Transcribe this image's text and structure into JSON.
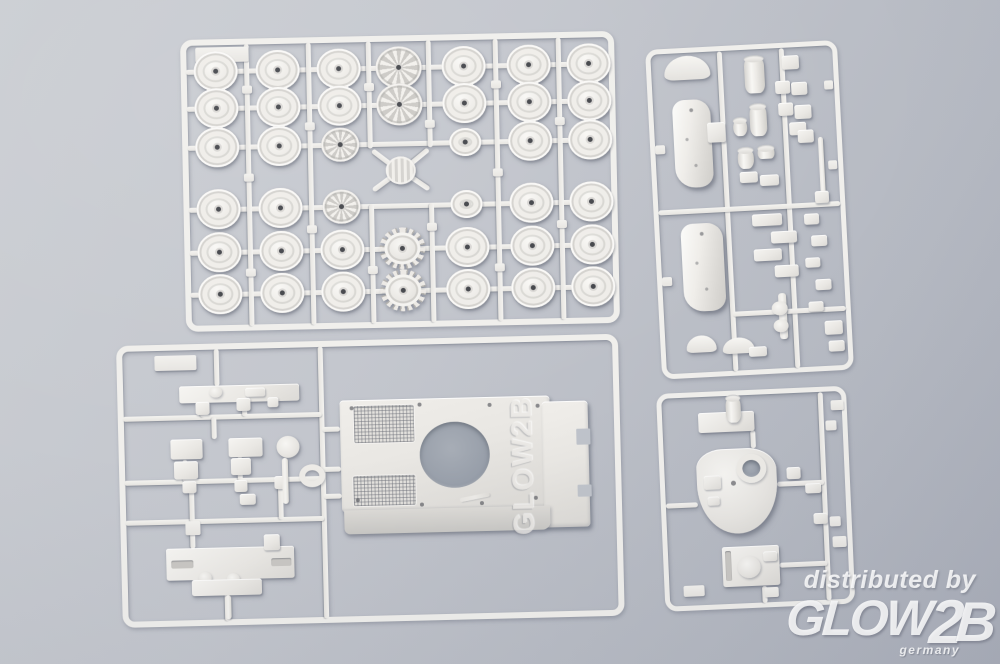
{
  "scene": {
    "type": "product-photo",
    "subject": "white plastic model kit sprues with tank parts on gray surface",
    "background_top_color": "#cbced3",
    "background_bottom_color": "#abafba",
    "plastic_color": "#f0efec"
  },
  "watermark": {
    "line1": "distributed by",
    "logo_main": "GLOW",
    "logo_digit": "2",
    "logo_last": "B",
    "line3": "germany",
    "embossed_logo": "GLOW2B",
    "text_color": "#ffffff"
  },
  "sprues": {
    "wheel_sprue": {
      "x": 180,
      "y": 40,
      "w": 434,
      "h": 292,
      "rot": -1.2,
      "bw": 6,
      "cols": [
        35,
        97,
        158,
        218,
        283,
        348,
        408
      ],
      "rows": [
        32,
        69,
        108,
        170,
        213,
        255
      ],
      "types": [
        [
          "p",
          "p",
          "p",
          "S",
          "p",
          "p",
          "p"
        ],
        [
          "p",
          "p",
          "p",
          "S",
          "p",
          "p",
          "p"
        ],
        [
          "p",
          "p",
          "s",
          "-",
          "m",
          "p",
          "p"
        ],
        [
          "p",
          "p",
          "s",
          "-",
          "m",
          "p",
          "p"
        ],
        [
          "p",
          "p",
          "p",
          "T",
          "p",
          "p",
          "p"
        ],
        [
          "p",
          "p",
          "p",
          "T",
          "p",
          "p",
          "p"
        ]
      ],
      "wheel_sizes": {
        "p": [
          44,
          40
        ],
        "m": [
          32,
          28
        ],
        "s": [
          38,
          34
        ],
        "S": [
          46,
          42
        ],
        "T": [
          46,
          42
        ]
      },
      "wheel_names": {
        "p": "road-wheel",
        "m": "small-road-wheel",
        "s": "spoked-wheel",
        "S": "idler-sprocket-wheel",
        "T": "drive-sprocket"
      },
      "verticals": [
        66,
        128,
        315,
        378
      ],
      "center_verticals": [
        188,
        248
      ],
      "center_gap_rows": [
        112,
        168
      ],
      "diagonals": [
        [
          190,
          114,
          214,
          133
        ],
        [
          246,
          114,
          222,
          133
        ],
        [
          190,
          154,
          214,
          137
        ],
        [
          246,
          154,
          222,
          137
        ]
      ],
      "label_tab": [
        15,
        8,
        53,
        15
      ],
      "center_part": [
        203,
        121,
        30,
        28
      ]
    },
    "detail_sprue": {
      "x": 645,
      "y": 50,
      "w": 192,
      "h": 330,
      "rot": -3,
      "bw": 5,
      "runners": [
        [
          74,
          5,
          74,
          325
        ],
        [
          136,
          5,
          136,
          325
        ],
        [
          5,
          163,
          187,
          163
        ],
        [
          74,
          268,
          187,
          268
        ]
      ],
      "parts": [
        [
          "arc",
          18,
          8,
          46,
          24,
          {
            "nm": "fender-part"
          }
        ],
        [
          "hullside",
          24,
          52,
          38,
          88,
          {
            "nm": "hull-side-panel"
          }
        ],
        [
          "rect",
          58,
          76,
          18,
          20
        ],
        [
          "hullside",
          26,
          176,
          42,
          88,
          {
            "nm": "hull-side-panel"
          }
        ],
        [
          "cyl",
          98,
          13,
          20,
          36,
          {
            "nm": "exhaust-pipe"
          }
        ],
        [
          "cyl",
          101,
          61,
          17,
          31,
          {
            "nm": "exhaust-pipe"
          }
        ],
        [
          "cyl",
          84,
          74,
          14,
          17
        ],
        [
          "cyl",
          87,
          104,
          16,
          20
        ],
        [
          "cyl",
          107,
          103,
          17,
          12
        ],
        [
          "rect",
          88,
          127,
          18,
          11
        ],
        [
          "rect",
          108,
          131,
          19,
          11
        ],
        [
          "rect",
          136,
          13,
          17,
          14
        ],
        [
          "rect",
          128,
          38,
          15,
          13
        ],
        [
          "rect",
          144,
          40,
          16,
          13
        ],
        [
          "rect",
          130,
          60,
          15,
          13
        ],
        [
          "rect",
          146,
          63,
          17,
          14
        ],
        [
          "rect",
          140,
          80,
          17,
          13
        ],
        [
          "rect",
          148,
          88,
          16,
          13
        ],
        [
          "rod",
          168,
          96,
          5,
          60
        ],
        [
          "rect",
          162,
          150,
          14,
          12
        ],
        [
          "rect",
          98,
          170,
          30,
          12
        ],
        [
          "rect",
          116,
          188,
          26,
          12
        ],
        [
          "rect",
          98,
          205,
          28,
          12
        ],
        [
          "rect",
          118,
          222,
          24,
          12
        ],
        [
          "rect",
          150,
          172,
          15,
          11
        ],
        [
          "rect",
          156,
          194,
          16,
          11
        ],
        [
          "rect",
          149,
          216,
          15,
          10
        ],
        [
          "rect",
          158,
          238,
          16,
          11
        ],
        [
          "rect",
          150,
          260,
          15,
          10
        ],
        [
          "rod",
          120,
          250,
          8,
          46,
          {
            "nm": "barrel-part"
          }
        ],
        [
          "circle",
          113,
          258,
          16,
          14
        ],
        [
          "circle",
          114,
          276,
          15,
          13
        ],
        [
          "arc",
          26,
          288,
          30,
          17
        ],
        [
          "arc",
          62,
          292,
          32,
          16
        ],
        [
          "rect",
          88,
          302,
          18,
          10
        ],
        [
          "rect",
          165,
          280,
          18,
          14
        ],
        [
          "rect",
          168,
          300,
          16,
          11
        ],
        [
          "tab",
          5,
          96,
          10,
          9
        ],
        [
          "tab",
          5,
          228,
          10,
          9
        ],
        [
          "tab",
          177,
          40,
          9,
          9
        ],
        [
          "tab",
          177,
          120,
          9,
          9
        ]
      ]
    },
    "hull_sprue": {
      "x": 116,
      "y": 346,
      "w": 502,
      "h": 282,
      "rot": -1.4,
      "bw": 6,
      "runners": [
        [
          204,
          5,
          204,
          277
        ],
        [
          5,
          73,
          204,
          73
        ],
        [
          5,
          137,
          204,
          137
        ],
        [
          5,
          177,
          204,
          177
        ],
        [
          100,
          5,
          100,
          42
        ],
        [
          85,
          58,
          85,
          73
        ],
        [
          127,
          55,
          127,
          73
        ],
        [
          96,
          73,
          96,
          95
        ],
        [
          66,
          115,
          66,
          137
        ],
        [
          121,
          113,
          121,
          137
        ],
        [
          72,
          137,
          72,
          177
        ],
        [
          161,
          137,
          161,
          177
        ],
        [
          72,
          177,
          72,
          204
        ],
        [
          105,
          250,
          105,
          277
        ],
        [
          204,
          88,
          222,
          88
        ],
        [
          204,
          128,
          222,
          128
        ],
        [
          204,
          155,
          222,
          155
        ]
      ],
      "parts": [
        [
          "tab",
          38,
          11,
          42,
          15,
          {
            "nm": "sprue-label-tab"
          }
        ],
        [
          "rect",
          62,
          42,
          120,
          17,
          {
            "nm": "long-detail-part"
          }
        ],
        [
          "circle",
          92,
          43,
          13,
          11
        ],
        [
          "rect",
          128,
          45,
          20,
          9
        ],
        [
          "rect",
          78,
          58,
          14,
          13
        ],
        [
          "rect",
          119,
          55,
          14,
          13
        ],
        [
          "rect",
          150,
          55,
          11,
          10
        ],
        [
          "rect",
          52,
          95,
          32,
          20,
          {
            "nm": "bracket-part"
          }
        ],
        [
          "rect",
          110,
          95,
          34,
          19,
          {
            "nm": "bracket-part"
          }
        ],
        [
          "rect",
          55,
          117,
          24,
          18
        ],
        [
          "rect",
          112,
          115,
          20,
          17
        ],
        [
          "rect",
          63,
          137,
          14,
          12
        ],
        [
          "rect",
          115,
          137,
          13,
          12
        ],
        [
          "rect",
          155,
          134,
          13,
          13
        ],
        [
          "circle",
          158,
          94,
          23,
          22,
          {
            "nm": "pulley-part"
          }
        ],
        [
          "rod",
          163,
          116,
          6,
          46
        ],
        [
          "ring",
          180,
          123,
          26,
          23,
          {
            "nm": "ring-part"
          }
        ],
        [
          "rect",
          120,
          151,
          16,
          11
        ],
        [
          "tab",
          65,
          177,
          15,
          14
        ],
        [
          "rect",
          45,
          204,
          128,
          32,
          {
            "nm": "hull-lower-part"
          }
        ],
        [
          "slot",
          50,
          216,
          22,
          8
        ],
        [
          "slot",
          150,
          216,
          20,
          8
        ],
        [
          "circle",
          77,
          228,
          13,
          12
        ],
        [
          "circle",
          105,
          230,
          13,
          12
        ],
        [
          "rect",
          70,
          236,
          70,
          16
        ],
        [
          "rect",
          143,
          192,
          16,
          16
        ],
        [
          "rod",
          103,
          252,
          6,
          24
        ],
        [
          "plate",
          222,
          60,
          210,
          112,
          {
            "nm": "upper-hull-plate"
          }
        ],
        [
          "plate",
          424,
          66,
          46,
          126,
          {
            "nm": "hull-rear-deck"
          }
        ],
        [
          "notch",
          458,
          94,
          14,
          16
        ],
        [
          "notch",
          458,
          150,
          14,
          12
        ],
        [
          "skirt",
          224,
          170,
          206,
          24,
          {
            "nm": "hull-front-edge"
          }
        ],
        [
          "grille",
          236,
          66,
          60,
          37,
          {
            "nm": "engine-grille"
          }
        ],
        [
          "grille",
          234,
          136,
          62,
          30,
          {
            "nm": "engine-grille"
          }
        ],
        [
          "hole",
          301,
          84,
          70,
          66,
          {
            "nm": "turret-ring-opening"
          }
        ],
        [
          "dot",
          232,
          66,
          4,
          4
        ],
        [
          "dot",
          300,
          64,
          4,
          4
        ],
        [
          "dot",
          370,
          66,
          4,
          4
        ],
        [
          "dot",
          418,
          68,
          4,
          4
        ],
        [
          "dot",
          236,
          158,
          4,
          4
        ],
        [
          "dot",
          300,
          164,
          4,
          4
        ],
        [
          "dot",
          360,
          164,
          4,
          4
        ],
        [
          "dot",
          414,
          160,
          4,
          4
        ],
        [
          "rod",
          340,
          158,
          30,
          4,
          {
            "rot": -10,
            "o": 0.6
          }
        ]
      ],
      "embossed": {
        "x": 339,
        "y": 114,
        "w": 130,
        "h": 40
      }
    },
    "turret_sprue": {
      "x": 656,
      "y": 394,
      "w": 190,
      "h": 218,
      "rot": -2.5,
      "bw": 5,
      "runners": [
        [
          164,
          5,
          164,
          213
        ],
        [
          95,
          40,
          95,
          58
        ],
        [
          5,
          112,
          37,
          112
        ],
        [
          117,
          95,
          164,
          95
        ],
        [
          116,
          176,
          164,
          176
        ],
        [
          100,
          196,
          100,
          213
        ]
      ],
      "parts": [
        [
          "rect",
          41,
          21,
          56,
          20,
          {
            "nm": "mantlet-base"
          }
        ],
        [
          "cyl",
          69,
          6,
          15,
          26,
          {
            "nm": "gun-mount-cylinder"
          }
        ],
        [
          "turret",
          37,
          58,
          80,
          85,
          {
            "nm": "turret-roof"
          }
        ],
        [
          "hole",
          83,
          70,
          18,
          17
        ],
        [
          "ring",
          77,
          64,
          30,
          29,
          {
            "nm": "cupola-ring"
          }
        ],
        [
          "dot",
          71,
          90,
          5,
          5
        ],
        [
          "rect",
          44,
          84,
          17,
          14,
          {
            "o": 0.92
          }
        ],
        [
          "rect",
          47,
          105,
          12,
          9,
          {
            "o": 0.92
          }
        ],
        [
          "rect",
          59,
          156,
          57,
          40,
          {
            "nm": "turret-base-part"
          }
        ],
        [
          "slot",
          62,
          160,
          6,
          30
        ],
        [
          "circle",
          74,
          166,
          23,
          22
        ],
        [
          "rect",
          100,
          162,
          14,
          10
        ],
        [
          "rect",
          127,
          79,
          14,
          12
        ],
        [
          "rect",
          145,
          96,
          16,
          10
        ],
        [
          "rect",
          152,
          126,
          14,
          11
        ],
        [
          "tab",
          174,
          14,
          13,
          10
        ],
        [
          "tab",
          19,
          193,
          21,
          11
        ],
        [
          "tab",
          100,
          198,
          14,
          10
        ],
        [
          "tab",
          170,
          150,
          14,
          11
        ],
        [
          "tab",
          168,
          34,
          11,
          10
        ],
        [
          "tab",
          168,
          130,
          11,
          10
        ]
      ]
    }
  }
}
